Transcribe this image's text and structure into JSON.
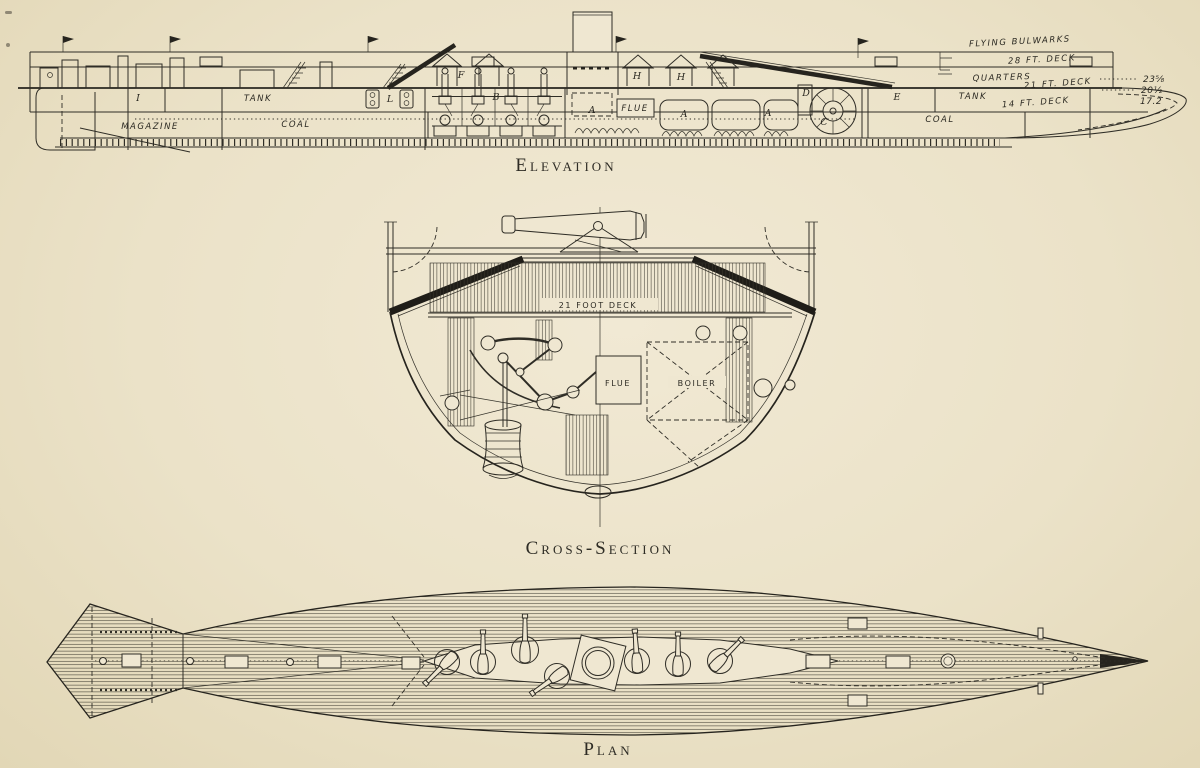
{
  "page": {
    "paper_color": "#ebe2c8",
    "ink_color": "#2f2d26"
  },
  "figure": {
    "views": {
      "elevation": {
        "caption": "Elevation",
        "labels": {
          "flying_bulwarks": "FLYING BULWARKS",
          "deck_28": "28 FT. DECK",
          "quarters": "QUARTERS",
          "deck_21": "21 FT. DECK",
          "tank_aft": "TANK",
          "deck_14": "14 FT. DECK",
          "coal_aft": "COAL",
          "tank_fwd": "TANK",
          "magazine": "MAGAZINE",
          "coal_fwd": "COAL",
          "flue": "FLUE"
        },
        "letters": {
          "i": "I",
          "l": "L",
          "f": "F",
          "b": "B",
          "a": "A",
          "h": "H",
          "d": "D",
          "c": "C",
          "e": "E"
        },
        "depths": [
          "23⅝",
          "20½",
          "17.2"
        ]
      },
      "cross_section": {
        "caption": "Cross-Section",
        "labels": {
          "deck_21": "21 FOOT DECK",
          "flue": "FLUE",
          "boiler": "BOILER"
        }
      },
      "plan": {
        "caption": "Plan"
      }
    }
  }
}
